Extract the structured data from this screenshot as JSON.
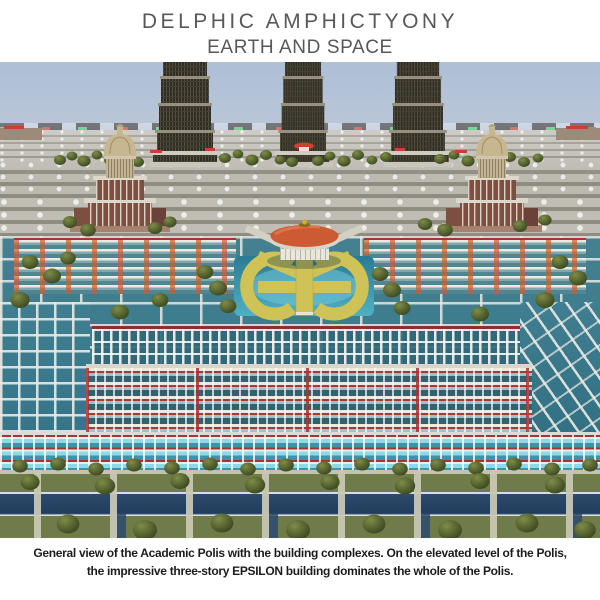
{
  "header": {
    "title_line1": "DELPHIC AMPHICTYONY",
    "title_line2": "EARTH AND SPACE",
    "text_color": "#57585a"
  },
  "figure": {
    "type": "3d-render",
    "subject": "Aerial view of the Academic Polis of the Delphic Amphictyony",
    "landmarks": {
      "solar_towers": "three dark tiered cylindrical towers on the horizon",
      "capitol_left": "domed classical building, left",
      "capitol_right": "domed classical building, right",
      "epsilon_building": "gold three-lobed EPSILON building at center",
      "rotunda": "round pavilion with orange conical roof above EPSILON",
      "plaza_grid": "grey stepped plaza blocks receding to horizon",
      "colonnade_complexes": "white colonnaded building rows with teal pools",
      "water_canals": "dark blue canals crossing the green lawns",
      "tree_rows": "rows of dark green trees"
    },
    "palette": {
      "sky": "#b6c4d7",
      "plaza_grey": "#918e84",
      "tower_dark": "#302d27",
      "gold": "#cfc257",
      "rotunda_orange": "#cc5a33",
      "pool_teal": "#3d93a8",
      "pool_cyan": "#8fd9e6",
      "red_trim": "#a9332e",
      "lawn_green": "#6f7c4a",
      "canal_blue": "#2c4a6b",
      "brick": "#7d4f41",
      "dome_tan": "#c6b78f"
    }
  },
  "caption": {
    "line1": "General view of the Academic Polis with the building complexes. On the elevated level of the Polis,",
    "line2": "the impressive three-story EPSILON building dominates the whole of the Polis."
  }
}
